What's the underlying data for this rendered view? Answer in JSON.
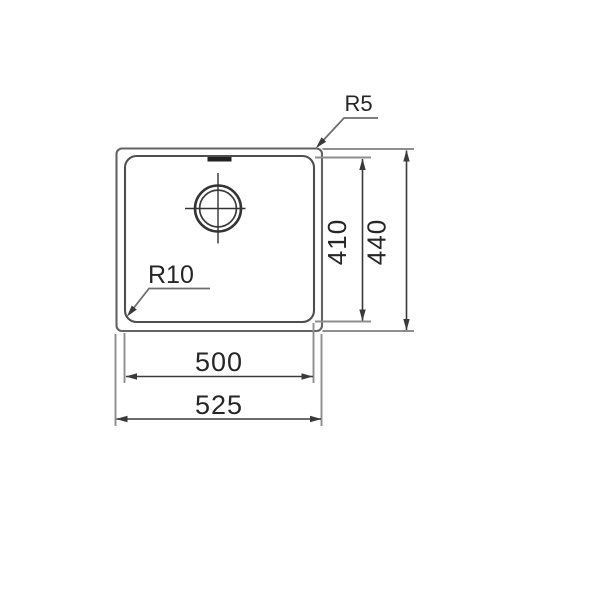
{
  "drawing": {
    "callouts": {
      "corner_radius_outer": "R5",
      "corner_radius_inner": "R10"
    },
    "dimensions": {
      "bowl_height": "410",
      "overall_height": "440",
      "bowl_width": "500",
      "overall_width": "525"
    },
    "colors": {
      "background": "#ffffff",
      "outline": "#636363",
      "bowl_outline": "#4f4f4f",
      "extension_line": "#8e8e8e",
      "dimension_line": "#3a3a3a",
      "label_text": "#262626"
    }
  }
}
